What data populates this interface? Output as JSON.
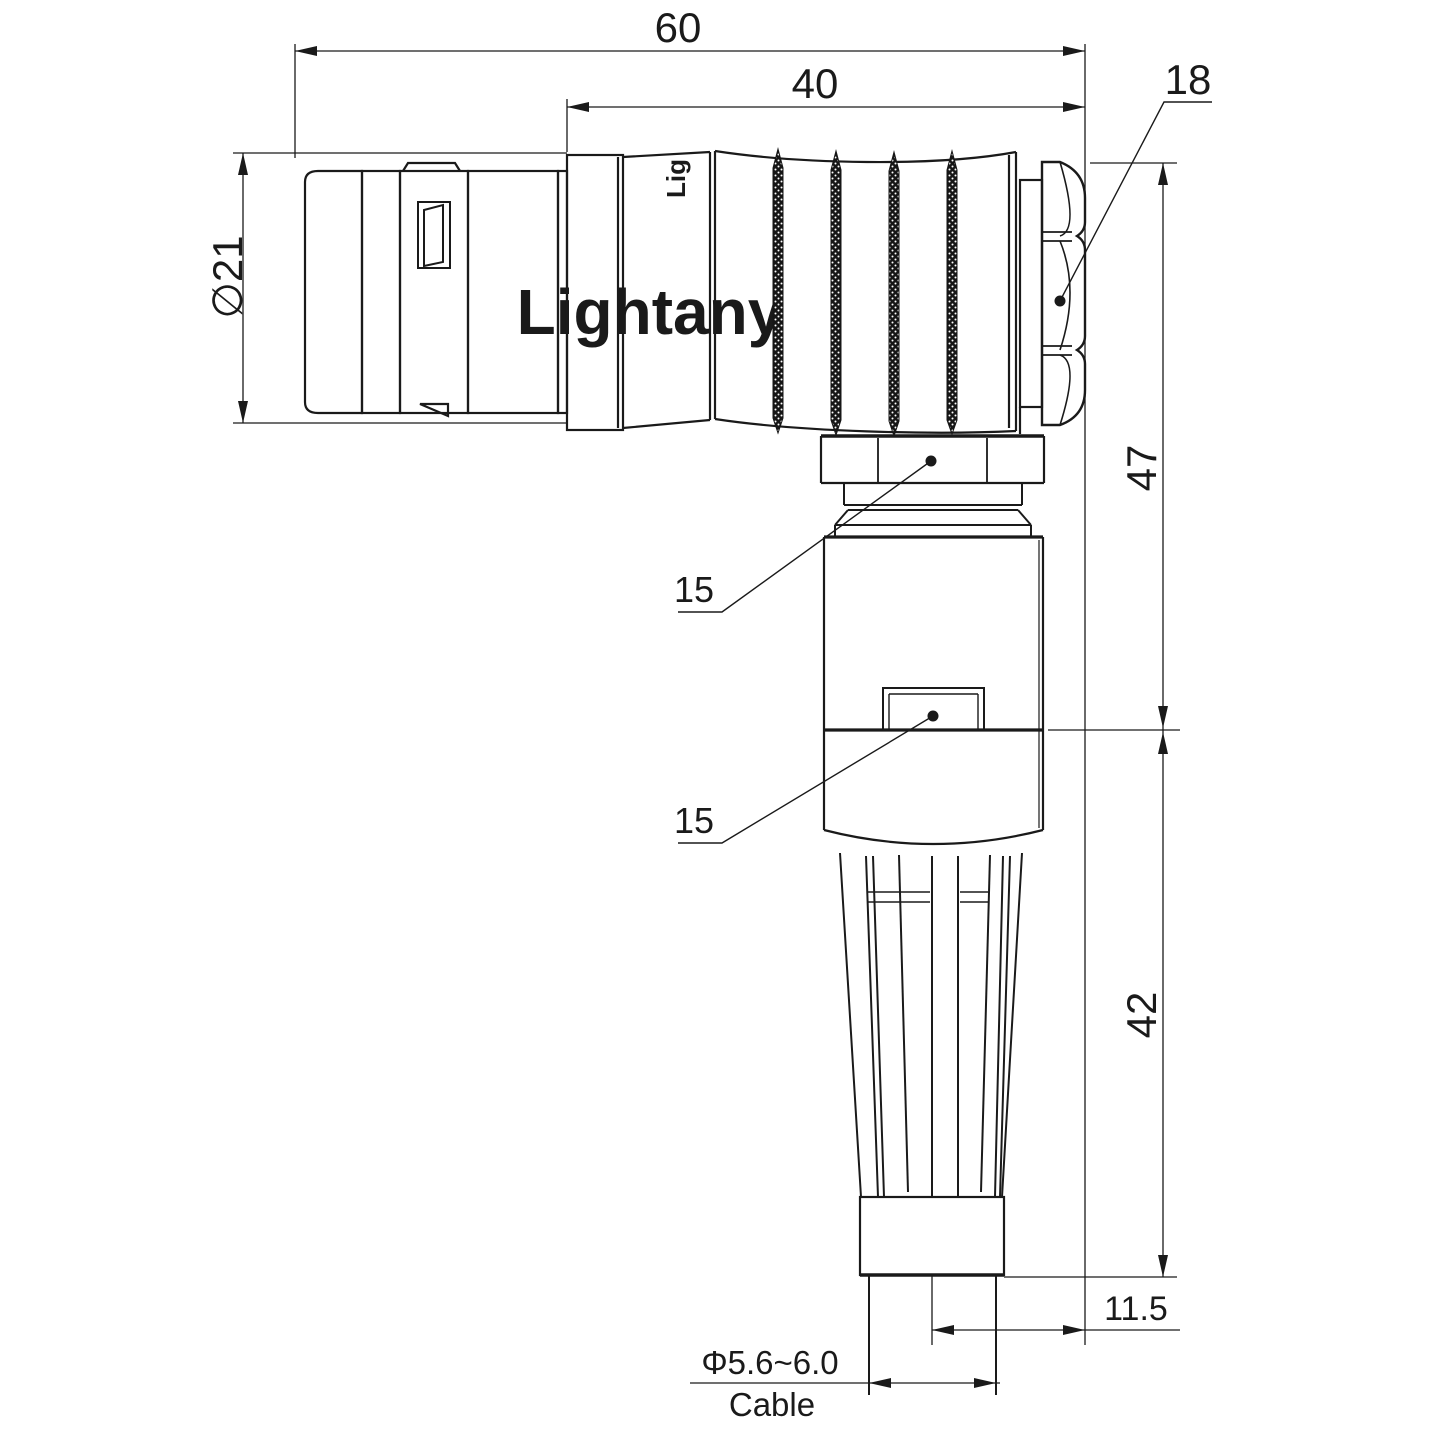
{
  "watermark": "Lightany",
  "barrel_logo": "Lig",
  "colors": {
    "ink": "#1a1a1a",
    "watermark_pink": "#f5c6c8"
  },
  "dims": {
    "overall_length": "60",
    "body_length": "40",
    "front_diameter": "∅21",
    "backnut_size": "18",
    "elbow_nut_flats": "15",
    "body_flats": "15",
    "upper_height": "47",
    "lower_height": "42",
    "axis_offset": "11.5",
    "cable_diameter": "Φ5.6~6.0",
    "cable_label": "Cable"
  }
}
